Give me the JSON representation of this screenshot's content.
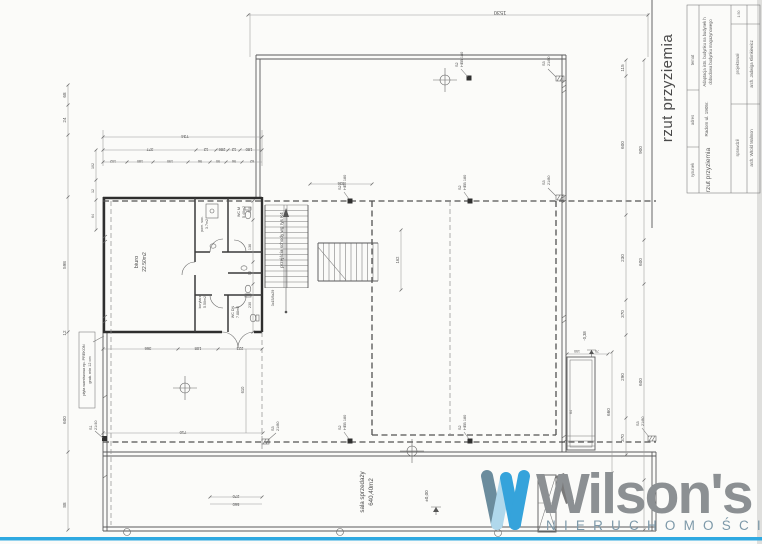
{
  "title_block": {
    "big_title": "rzut przyziemia",
    "rows": [
      {
        "label": "temat",
        "value_line1": "Adaptacja istn. budynku na budynek h",
        "value_line2": "dobudowa budynku magazynowego"
      },
      {
        "label": "adres",
        "value": "Radom ul. 1905r."
      },
      {
        "label": "rysunek",
        "value": "rzut przyziemia"
      },
      {
        "label": "projektował",
        "value": "arch. Jadwiga Klimkiewicz"
      },
      {
        "label": "sprawdził",
        "value": "arch. Witold Malmon"
      }
    ],
    "scale": "1:50"
  },
  "logo": {
    "brand": "Wilson's",
    "tagline": "NIERUCHOMOŚCI"
  },
  "rooms": [
    {
      "name": "biuro",
      "area": "22.50m2"
    },
    {
      "name": "pom. soc.",
      "area": "3.7m2"
    },
    {
      "name": "WC M",
      "area": "5.40m2"
    },
    {
      "name": "korytarz",
      "area": "5.50m2"
    },
    {
      "name": "WC DN",
      "area": "7.88m2"
    },
    {
      "name": "sala sprzedaży",
      "area": "640,40m2"
    }
  ],
  "notes": {
    "stairs": "przejścia schody wg rys K4",
    "stairs_run": "3x15/8x29",
    "panel_line1": "płyta warstwowa np. PREKON",
    "panel_line2": "grub. min 12 cm"
  },
  "levels": {
    "main": "±0,00",
    "dock": "-0,38"
  },
  "markers": {
    "s1": {
      "code": "S1",
      "spec": "21/40"
    },
    "s2": {
      "code": "S2",
      "spec": "HEB 180"
    },
    "s3": {
      "code": "S3",
      "spec": "21/80"
    }
  },
  "dims": {
    "top": "1530",
    "tl1": [
      "734"
    ],
    "tl2": [
      "377",
      "12",
      "286",
      "12",
      "180"
    ],
    "tl3": [
      "102",
      "180",
      "190",
      "96",
      "90",
      "96",
      "62"
    ],
    "left": [
      "68",
      "24",
      "598",
      "12",
      "600",
      "88"
    ],
    "left2": [
      "102",
      "12",
      "64"
    ],
    "right1": [
      "115",
      "600",
      "230",
      "370",
      "290",
      "370"
    ],
    "right2": [
      "900",
      "600",
      "600",
      "660"
    ],
    "bottom": [
      "366",
      "108",
      "223",
      "610",
      "710",
      "270",
      "560"
    ],
    "stair": [
      "110",
      "136",
      "52",
      "230",
      "162",
      "336"
    ],
    "dock": [
      "150",
      "75",
      "64"
    ]
  }
}
